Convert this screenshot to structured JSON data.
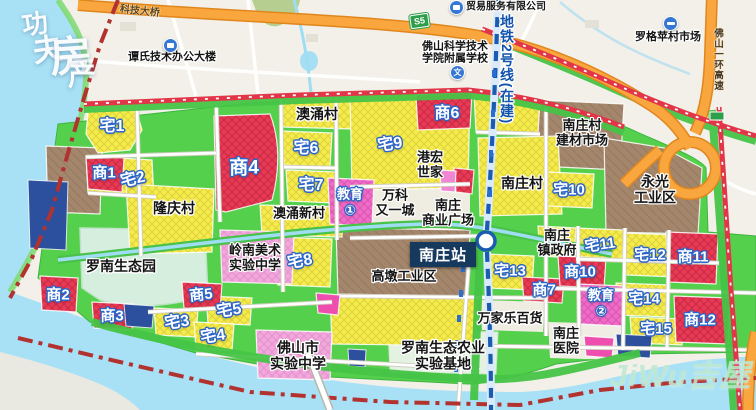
{
  "metro": {
    "line_label": "地铁2号线(在建)",
    "station_label": "南庄站"
  },
  "roads": {
    "ring_label": "佛山一环高速",
    "bridge_label": "科技大桥",
    "s5_label": "S5"
  },
  "watermark_tl": {
    "chars": [
      {
        "t": "功",
        "x": 22,
        "y": 12,
        "size": 26,
        "rot": -8
      },
      {
        "t": "夫",
        "x": 33,
        "y": 36,
        "size": 30,
        "rot": -8
      },
      {
        "t": "房",
        "x": 50,
        "y": 36,
        "size": 42,
        "rot": -4
      },
      {
        "t": "产",
        "x": 68,
        "y": 62,
        "size": 28,
        "rot": 0
      }
    ]
  },
  "watermark_br": {
    "text": "JiWu吉屋",
    "x": 610,
    "y": 350
  },
  "colors": {
    "residential_zone": "#f5ec4c",
    "commercial_zone": "#e93a55",
    "education_zone": "#ef6cc8",
    "industrial_zone": "#a3866b",
    "utility_zone": "#2c4f9e",
    "green_space": "#55d04c",
    "water": "#a8e1f5",
    "metro_line": "#1b5cb0",
    "arterial_road": "#e23548",
    "highway": "#f9a63e",
    "boundary": "#b23230"
  },
  "zone_labels": [
    {
      "id": "zhai-1",
      "text": "宅1",
      "x": 112,
      "y": 127,
      "size": 16,
      "rot": 0
    },
    {
      "id": "shang-1",
      "text": "商1",
      "x": 104,
      "y": 173,
      "size": 15,
      "rot": 0
    },
    {
      "id": "zhai-2",
      "text": "宅2",
      "x": 133,
      "y": 180,
      "size": 16,
      "rot": -12
    },
    {
      "id": "shang-4",
      "text": "商4",
      "x": 244,
      "y": 168,
      "size": 19,
      "rot": 0
    },
    {
      "id": "zhai-6",
      "text": "宅6",
      "x": 306,
      "y": 149,
      "size": 16,
      "rot": 0
    },
    {
      "id": "zhai-7",
      "text": "宅7",
      "x": 311,
      "y": 186,
      "size": 16,
      "rot": 0
    },
    {
      "id": "zhai-9",
      "text": "宅9",
      "x": 390,
      "y": 145,
      "size": 16,
      "rot": -8
    },
    {
      "id": "shang-6",
      "text": "商6",
      "x": 447,
      "y": 114,
      "size": 16,
      "rot": 0
    },
    {
      "id": "zhai-8",
      "text": "宅8",
      "x": 300,
      "y": 262,
      "size": 16,
      "rot": -10
    },
    {
      "id": "shang-5",
      "text": "商5",
      "x": 201,
      "y": 295,
      "size": 15,
      "rot": -6
    },
    {
      "id": "zhai-5",
      "text": "宅5",
      "x": 229,
      "y": 311,
      "size": 16,
      "rot": -8
    },
    {
      "id": "zhai-3",
      "text": "宅3",
      "x": 177,
      "y": 323,
      "size": 16,
      "rot": -8
    },
    {
      "id": "zhai-4",
      "text": "宅4",
      "x": 213,
      "y": 337,
      "size": 16,
      "rot": -8
    },
    {
      "id": "shang-2",
      "text": "商2",
      "x": 58,
      "y": 295,
      "size": 15,
      "rot": 0
    },
    {
      "id": "shang-3",
      "text": "商3",
      "x": 112,
      "y": 316,
      "size": 15,
      "rot": 0
    },
    {
      "id": "zhai-10",
      "text": "宅10",
      "x": 569,
      "y": 190,
      "size": 15,
      "rot": 0
    },
    {
      "id": "zhai-11",
      "text": "宅11",
      "x": 600,
      "y": 245,
      "size": 15,
      "rot": -8
    },
    {
      "id": "zhai-12",
      "text": "宅12",
      "x": 650,
      "y": 255,
      "size": 15,
      "rot": 0
    },
    {
      "id": "shang-11",
      "text": "商11",
      "x": 693,
      "y": 257,
      "size": 15,
      "rot": 0
    },
    {
      "id": "shang-10",
      "text": "商10",
      "x": 580,
      "y": 272,
      "size": 15,
      "rot": 0
    },
    {
      "id": "shang-7",
      "text": "商7",
      "x": 544,
      "y": 290,
      "size": 15,
      "rot": 0
    },
    {
      "id": "zhai-13",
      "text": "宅13",
      "x": 510,
      "y": 271,
      "size": 15,
      "rot": 0
    },
    {
      "id": "zhai-14",
      "text": "宅14",
      "x": 644,
      "y": 299,
      "size": 15,
      "rot": 0
    },
    {
      "id": "zhai-15",
      "text": "宅15",
      "x": 656,
      "y": 329,
      "size": 15,
      "rot": 0
    },
    {
      "id": "shang-12",
      "text": "商12",
      "x": 700,
      "y": 320,
      "size": 15,
      "rot": 0
    }
  ],
  "edu_labels": [
    {
      "id": "edu-1",
      "lines": [
        "教育",
        "①"
      ],
      "x": 350,
      "y": 202,
      "size": 13
    },
    {
      "id": "edu-2",
      "lines": [
        "教育",
        "②"
      ],
      "x": 601,
      "y": 303,
      "size": 13
    }
  ],
  "place_labels": [
    {
      "id": "tanshi-office",
      "lines": [
        "谭氏技术办公大楼"
      ],
      "x": 172,
      "y": 57,
      "size": 11
    },
    {
      "id": "trade-company",
      "lines": [
        "贸易服务有限公司"
      ],
      "x": 506,
      "y": 7,
      "size": 10
    },
    {
      "id": "foshan-uni-school",
      "lines": [
        "佛山科学技术",
        "学院附属学校"
      ],
      "x": 455,
      "y": 53,
      "size": 11
    },
    {
      "id": "luoge-market",
      "lines": [
        "罗格苹村市场"
      ],
      "x": 668,
      "y": 37,
      "size": 11
    },
    {
      "id": "aochong-village",
      "lines": [
        "澳涌村"
      ],
      "x": 317,
      "y": 115,
      "size": 14
    },
    {
      "id": "aochong-new-village",
      "lines": [
        "澳涌新村"
      ],
      "x": 299,
      "y": 214,
      "size": 13
    },
    {
      "id": "longqing-village",
      "lines": [
        "隆庆村"
      ],
      "x": 174,
      "y": 209,
      "size": 14
    },
    {
      "id": "nanzhuang-village",
      "lines": [
        "南庄村"
      ],
      "x": 522,
      "y": 184,
      "size": 14
    },
    {
      "id": "jiancai-market",
      "lines": [
        "南庄村",
        "建材市场"
      ],
      "x": 582,
      "y": 133,
      "size": 13
    },
    {
      "id": "yongguang-industrial",
      "lines": [
        "永光",
        "工业区"
      ],
      "x": 655,
      "y": 190,
      "size": 14
    },
    {
      "id": "ganghong-shijia",
      "lines": [
        "港宏",
        "世家"
      ],
      "x": 430,
      "y": 165,
      "size": 13
    },
    {
      "id": "vanke-youyicheng",
      "lines": [
        "万科",
        "又一城"
      ],
      "x": 395,
      "y": 203,
      "size": 13
    },
    {
      "id": "nanzhuang-plaza",
      "lines": [
        "南庄",
        "商业广场"
      ],
      "x": 448,
      "y": 213,
      "size": 13
    },
    {
      "id": "nanzhuang-gov",
      "lines": [
        "南庄",
        "镇政府"
      ],
      "x": 557,
      "y": 243,
      "size": 13
    },
    {
      "id": "luonan-eco-park",
      "lines": [
        "罗南生态园"
      ],
      "x": 121,
      "y": 267,
      "size": 14
    },
    {
      "id": "lingnan-art-school",
      "lines": [
        "岭南美术",
        "实验中学"
      ],
      "x": 255,
      "y": 258,
      "size": 13
    },
    {
      "id": "gaodun-industrial",
      "lines": [
        "高墩工业区"
      ],
      "x": 404,
      "y": 277,
      "size": 13
    },
    {
      "id": "wanjiale-store",
      "lines": [
        "万家乐百货"
      ],
      "x": 510,
      "y": 319,
      "size": 13
    },
    {
      "id": "nanzhuang-hospital",
      "lines": [
        "南庄",
        "医院"
      ],
      "x": 566,
      "y": 341,
      "size": 13
    },
    {
      "id": "foshan-exp-school",
      "lines": [
        "佛山市",
        "实验中学"
      ],
      "x": 298,
      "y": 356,
      "size": 14
    },
    {
      "id": "luonan-agri-base",
      "lines": [
        "罗南生态农业",
        "实验基地"
      ],
      "x": 443,
      "y": 356,
      "size": 14
    }
  ],
  "poi_icons": [
    {
      "id": "bus-stop-tanshi",
      "type": "bus",
      "x": 169,
      "y": 44
    },
    {
      "id": "bus-stop-trade",
      "type": "bus",
      "x": 455,
      "y": 6
    },
    {
      "id": "school-fushu",
      "type": "school",
      "x": 456,
      "y": 71,
      "glyph": "文"
    },
    {
      "id": "metro-luoge",
      "type": "metro",
      "x": 669,
      "y": 22
    }
  ]
}
